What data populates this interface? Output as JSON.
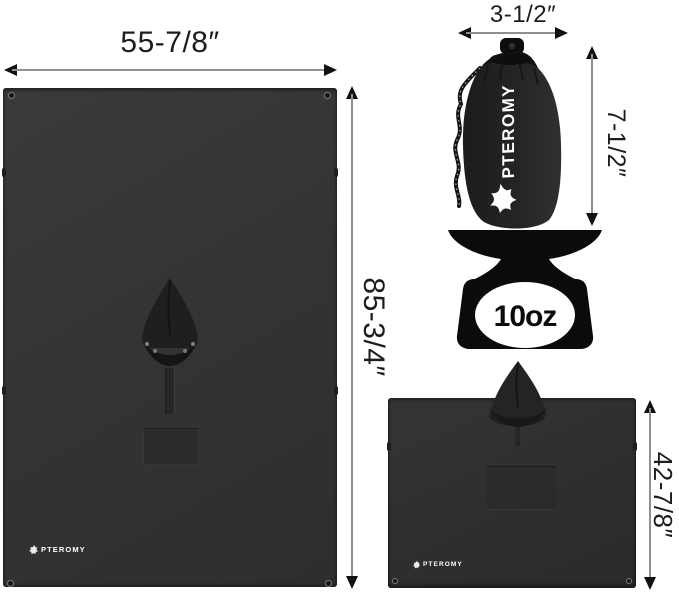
{
  "brand": "PTEROMY",
  "main_blanket": {
    "description": "hooded rain poncho opened flat",
    "width_label": "55-7/8″",
    "height_label": "85-3/4″",
    "logo_text": "PTEROMY"
  },
  "stuff_sack": {
    "description": "drawstring storage sack",
    "width_label": "3-1/2″",
    "height_label": "7-1/2″",
    "logo_text": "PTEROMY"
  },
  "scale": {
    "weight_label": "10oz"
  },
  "folded_poncho": {
    "description": "poncho worn shape with hood",
    "height_label": "42-7/8″",
    "logo_text": "PTEROMY"
  },
  "colors": {
    "background": "#ffffff",
    "tarp_fill": "#343434",
    "poncho_fill": "#2f2f2f",
    "sack_fill": "#242424",
    "hood_fill": "#1f1f1f",
    "scale_fill": "#0b0b0b",
    "dim_line": "#8f8f8f",
    "dim_arrow": "#111111",
    "dim_text": "#1d1d1d",
    "logo_white": "#ffffff"
  }
}
